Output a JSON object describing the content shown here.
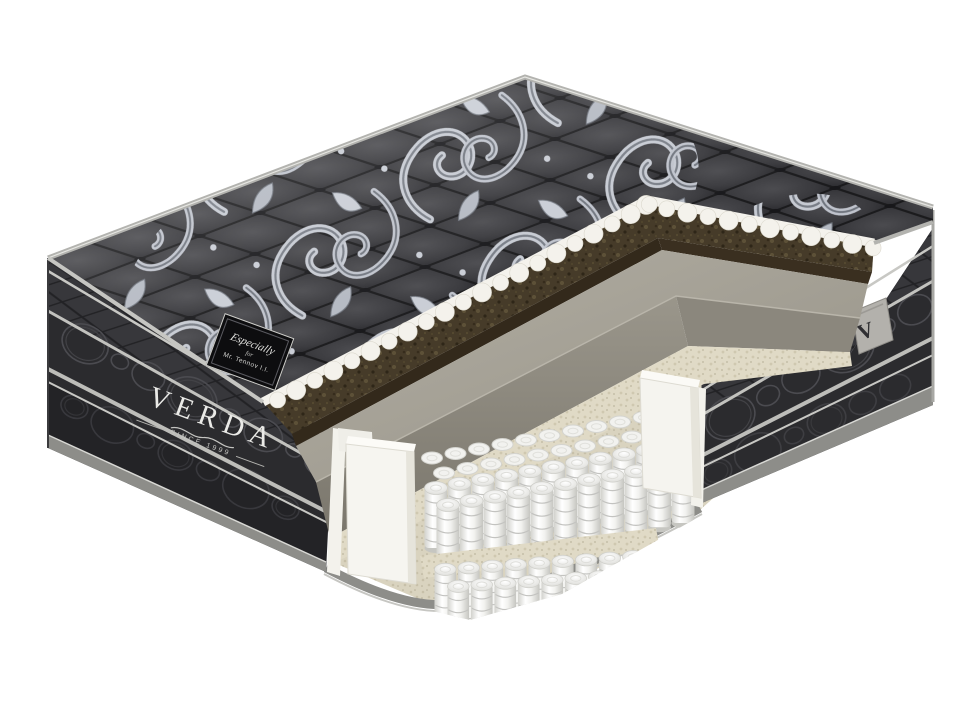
{
  "product": {
    "brand": "VERDA",
    "established": "SINCE 1999",
    "label_line1": "Especially",
    "label_line2": "for",
    "label_line3": "Mr. Tennov I.I.",
    "side_tag_letter": "V"
  },
  "palette": {
    "background": "#ffffff",
    "fabric_dark": "#2b2b2e",
    "quilt_dark": "#3c3c40",
    "damask_silver": "#c6cad2",
    "piping_grey": "#b3b3af",
    "coir_brown": "#463b29",
    "foam_grey": "#a39f94",
    "felt_beige": "#e0dac6",
    "spring_white": "#f5f5f3",
    "base_edge_grey": "#8d8d89"
  }
}
